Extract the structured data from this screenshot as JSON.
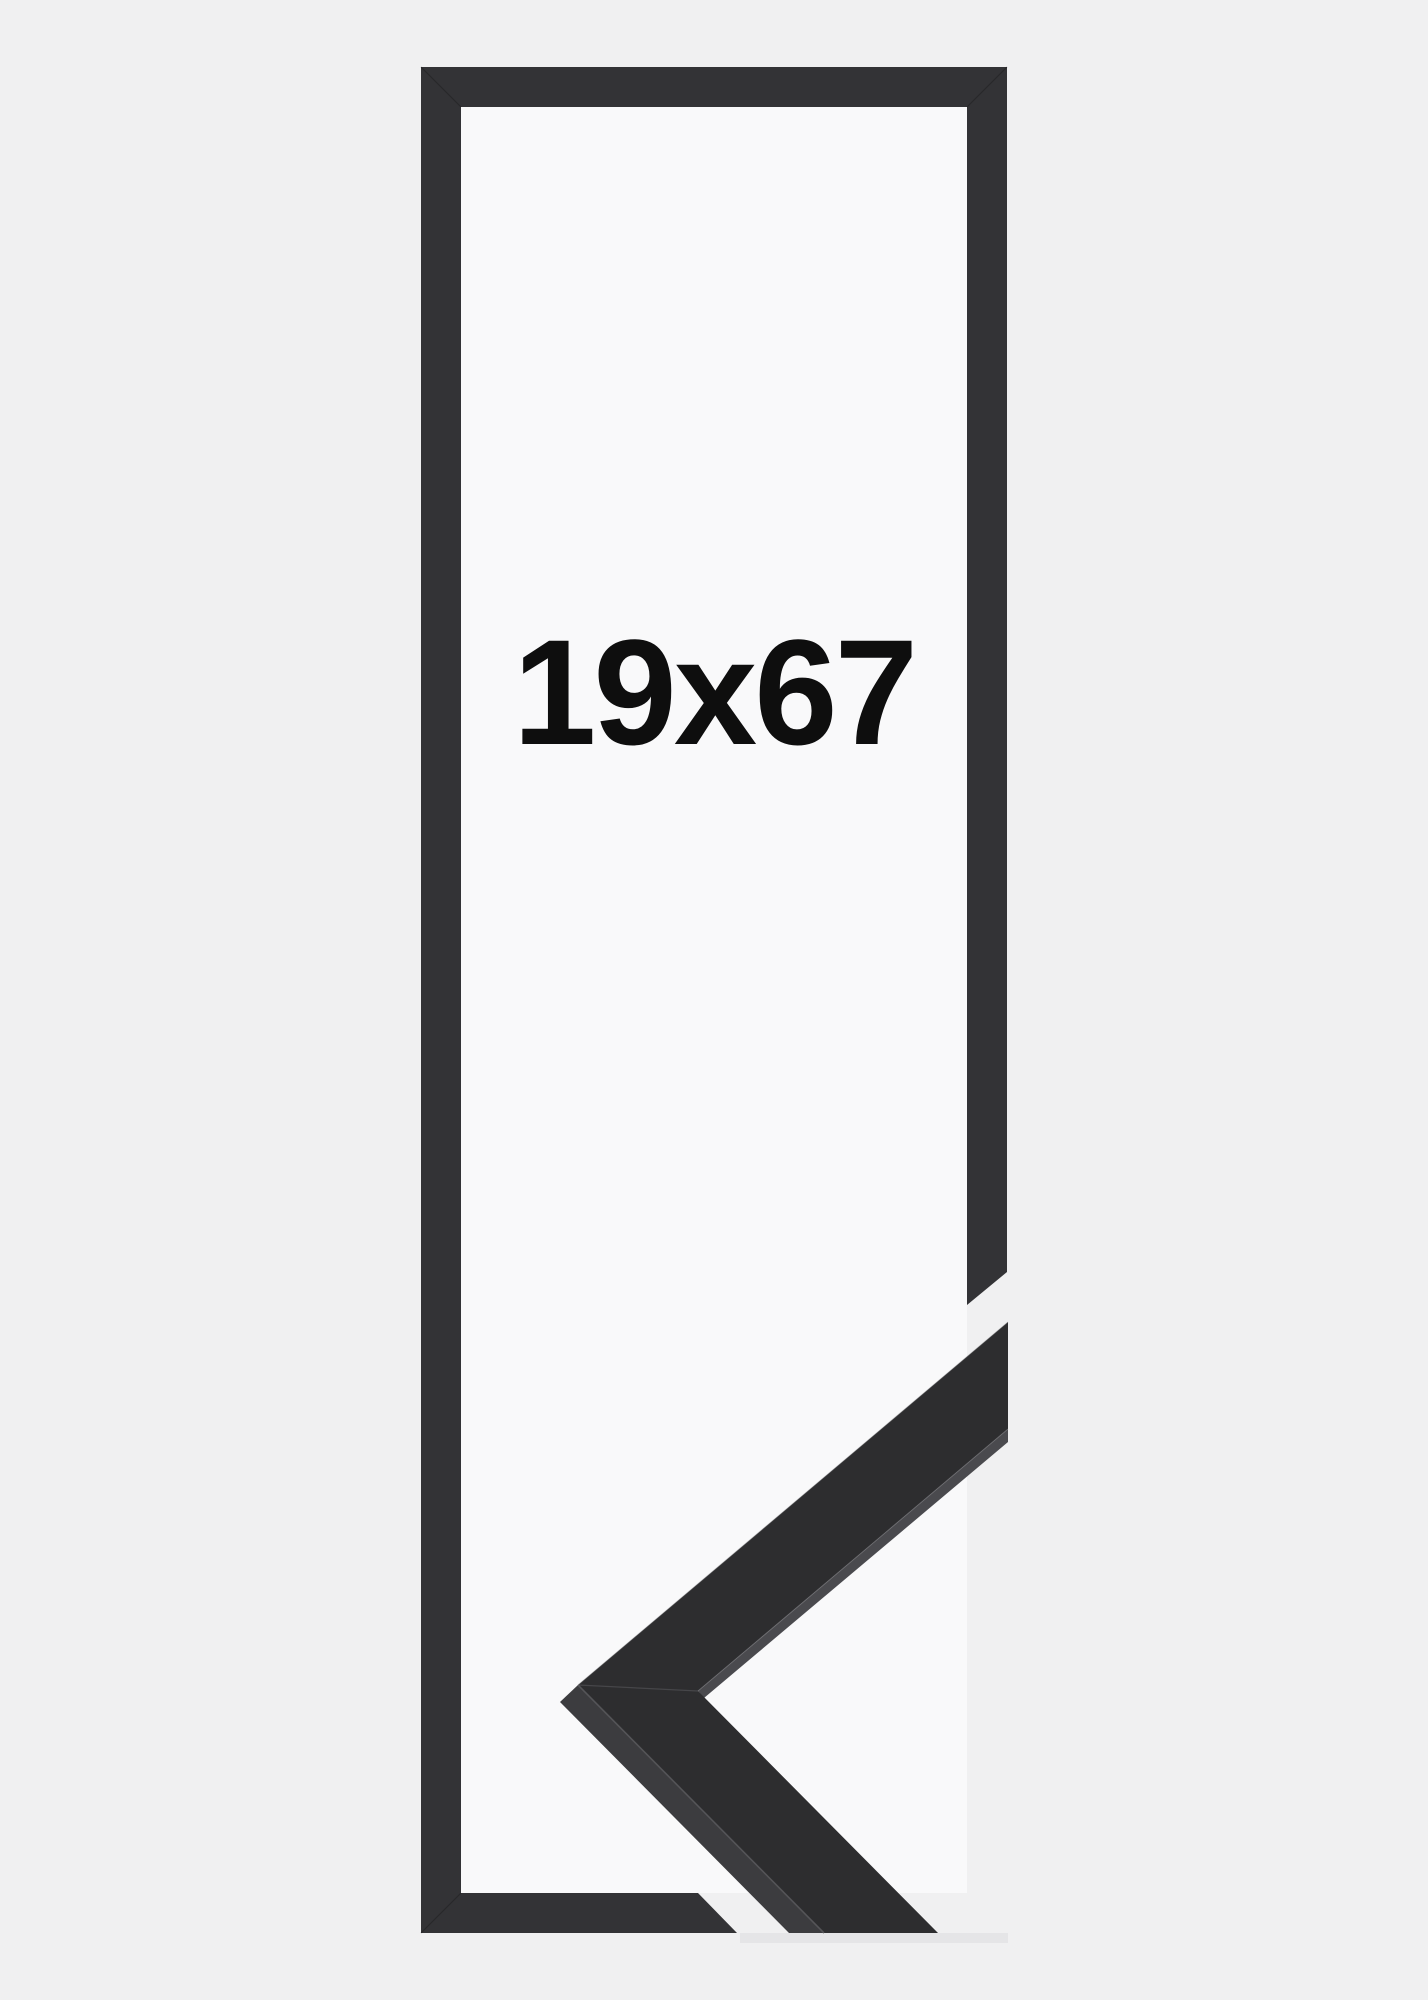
{
  "page": {
    "type": "frame-product-image",
    "description": "Black picture frame size illustration with corner moulding sample"
  },
  "size_label": "19x67",
  "colors": {
    "background": "#f0f0f1",
    "frame_inner": "#f9f9fa",
    "frame_outline": "#333336",
    "moulding_face": "#2d2d2f",
    "moulding_side": "#3c3c3f",
    "moulding_sliver": "#4a4a4e",
    "crease_highlight": "#56565a",
    "edge_highlight": "#8a8a8e",
    "label_text": "#0e0e0e",
    "shadow": "#e3e3e5"
  }
}
